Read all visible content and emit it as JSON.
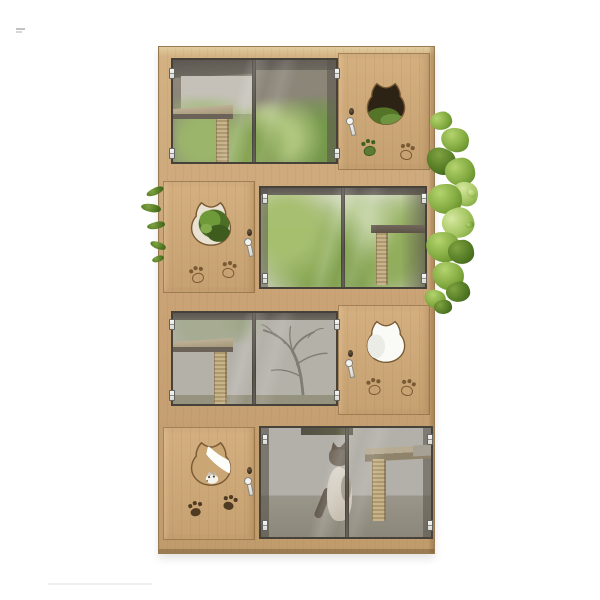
{
  "meta": {
    "caption": "3D product render of a four-tier light-oak cat house cabinet with framed glass doors, cat-head shaped door cutouts, hanging keys, engraved paw prints, sisal scratching posts, interior shelves, a seated siamese cat in the bottom tier, and green foliage behind and beside the unit on a white background",
    "watermark": {
      "visible": true,
      "legible": false,
      "text": ""
    }
  },
  "palette": {
    "background": "#ffffff",
    "wood": "#c9a478",
    "wood_light": "#e2cc9f",
    "wood_dark": "#9a7a50",
    "engraving_brown": "#7a5a34",
    "glass_frame": "#474239",
    "interior_dark": "#6e675c",
    "interior_light": "#b9b6ae",
    "foliage_green": "#83ab41",
    "foliage_dark": "#3e611a",
    "moss_green": "#4c6e25",
    "sisal": "#c4ae80",
    "hinge_metal": "#ececea",
    "cat_body": "#d9d2c6",
    "cat_points": "#6e6256"
  },
  "tiers": [
    {
      "label": "Tier 1: double glass doors on left with interior shelf, sisal scratching post and blurred trees; wooden door on right with dark moss-filled cat-head cutout, knob, hanging key, one green and one outlined paw print",
      "door_side": "right",
      "cutout_fill": "dark-with-moss",
      "paw_styles": [
        "filled-green",
        "outline"
      ]
    },
    {
      "label": "Tier 2: wooden door on left with moss-filled cat-head cutout, knob, hanging key and two outlined paw prints; double glass doors on right with bright foliage, wall shelf and sisal post",
      "door_side": "left",
      "cutout_fill": "moss",
      "paw_styles": [
        "outline",
        "outline"
      ]
    },
    {
      "label": "Tier 3: double glass doors on left with shelf, sisal post and bare-tree silhouette backdrop; wooden door on right with white cat-head cutout, knob, hanging key and two outlined paw prints",
      "door_side": "right",
      "cutout_fill": "white",
      "paw_styles": [
        "outline",
        "outline"
      ]
    },
    {
      "label": "Tier 4: wooden door on left with wood-and-white cat-head cutout containing a toy mouse, knob, hanging key and two dark filled paw prints; double glass doors on right with seated siamese cat, top shelf and table with sisal leg",
      "door_side": "left",
      "cutout_fill": "wood-and-white",
      "paw_styles": [
        "filled",
        "filled"
      ]
    }
  ],
  "components": [
    "cat-head-cutout-icon",
    "paw-print-icon",
    "key-icon",
    "door-knob",
    "hinge",
    "scratching-post",
    "shelf",
    "toy-mouse",
    "siamese-cat",
    "foliage"
  ]
}
